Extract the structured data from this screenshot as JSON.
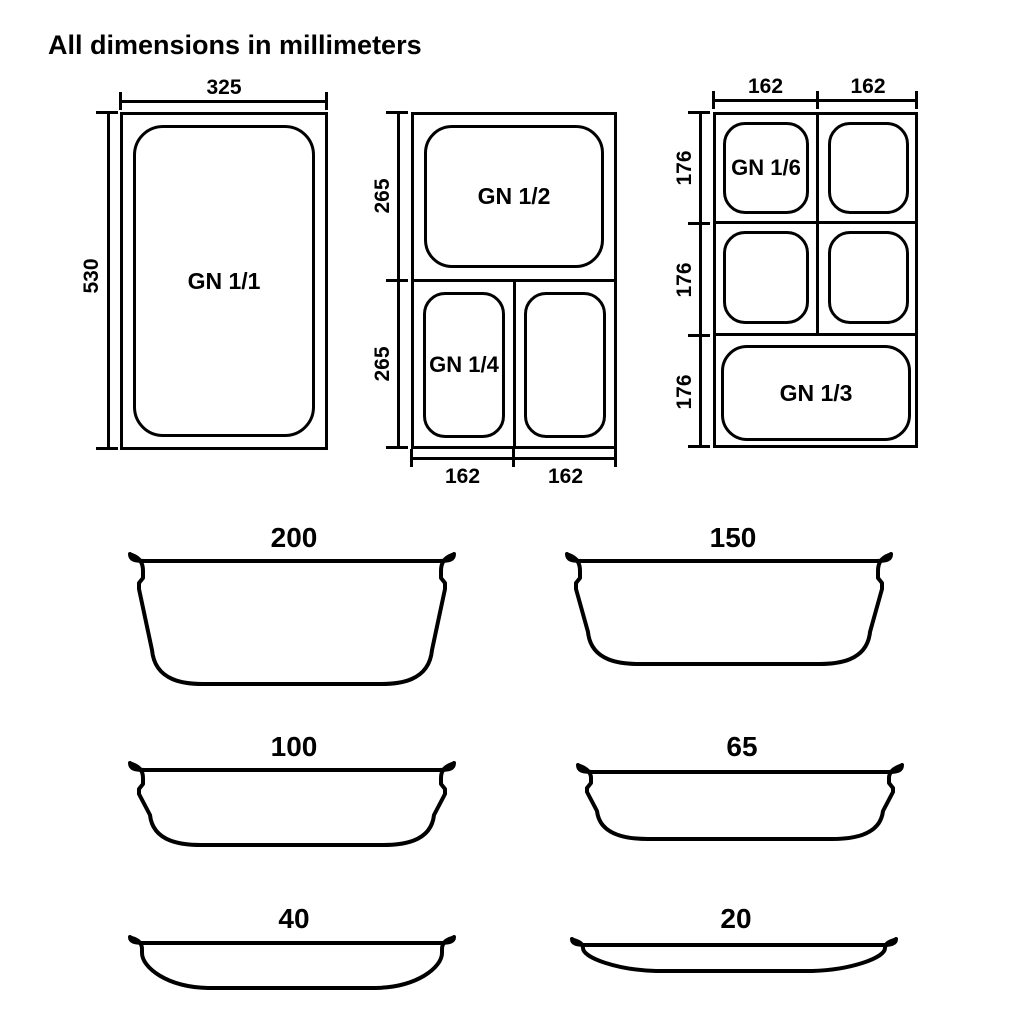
{
  "title": "All dimensions in millimeters",
  "top_views": {
    "gn_1_1": {
      "label": "GN 1/1",
      "width_mm": "325",
      "height_mm": "530"
    },
    "gn_1_2_1_4": {
      "top_pan_label": "GN 1/2",
      "bottom_left_pan_label": "GN 1/4",
      "left_dims": [
        "265",
        "265"
      ],
      "bottom_dims": [
        "162",
        "162"
      ]
    },
    "gn_1_6_1_3": {
      "first_pan_label": "GN 1/6",
      "bottom_pan_label": "GN 1/3",
      "top_dims": [
        "162",
        "162"
      ],
      "left_dims": [
        "176",
        "176",
        "176"
      ]
    }
  },
  "depth_profiles": [
    {
      "depth_mm": "200"
    },
    {
      "depth_mm": "150"
    },
    {
      "depth_mm": "100"
    },
    {
      "depth_mm": "65"
    },
    {
      "depth_mm": "40"
    },
    {
      "depth_mm": "20"
    }
  ]
}
